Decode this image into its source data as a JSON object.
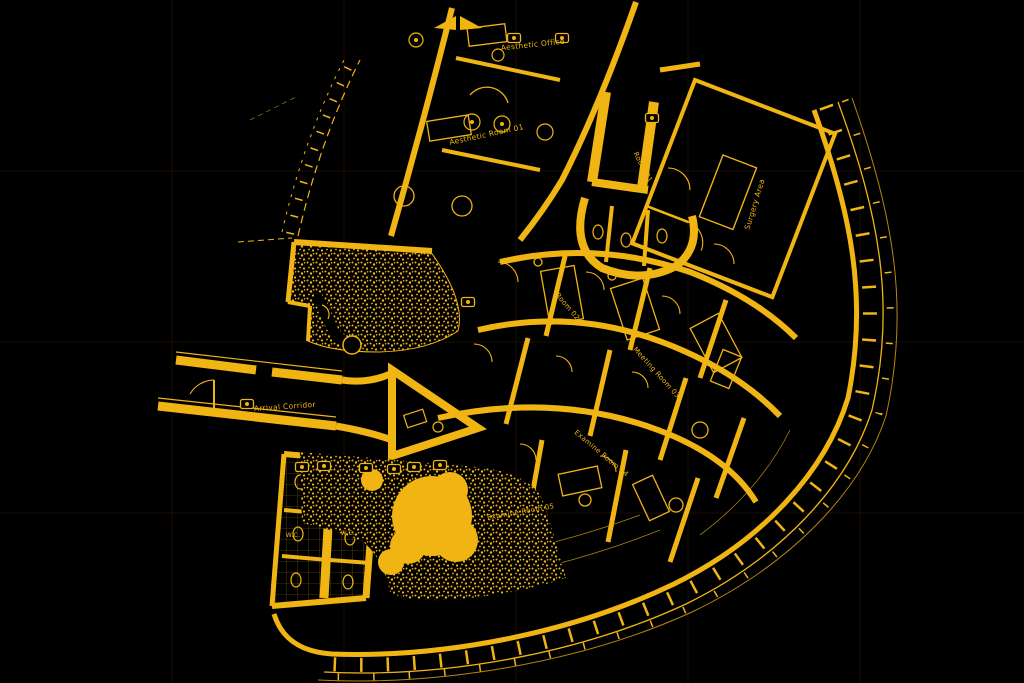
{
  "colors": {
    "background": "#000000",
    "ink": "#F0B413",
    "grid_faint": "#1C0D00"
  },
  "labels": [
    {
      "text": "Aesthetic Office"
    },
    {
      "text": "Aesthetic Room 01"
    },
    {
      "text": "Room 01"
    },
    {
      "text": "Room 02"
    },
    {
      "text": "Meeting Room 03"
    },
    {
      "text": "Examine Room 04"
    },
    {
      "text": "Examine Room 05"
    },
    {
      "text": "Surgery Area"
    },
    {
      "text": "Arrival Corridor"
    },
    {
      "text": "W.C."
    },
    {
      "text": "W.C."
    }
  ]
}
